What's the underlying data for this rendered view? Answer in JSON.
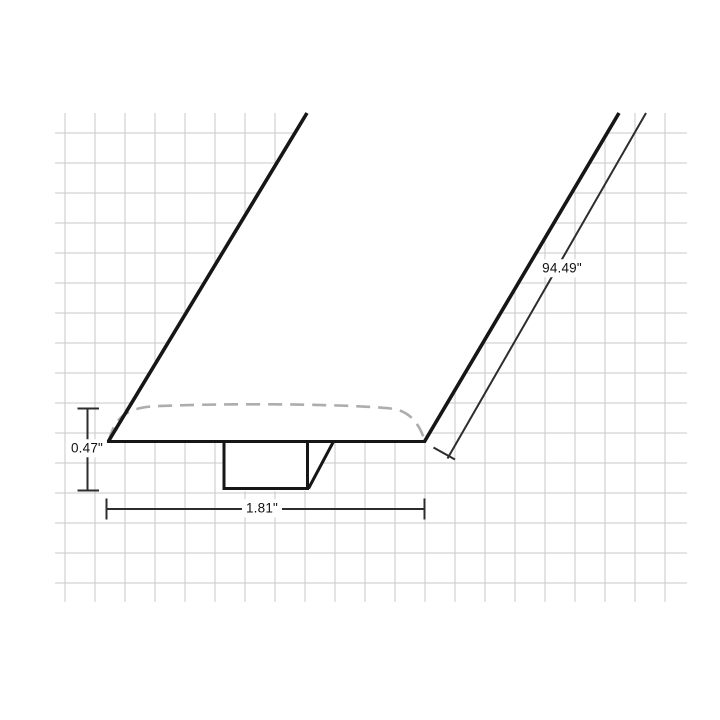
{
  "page": {
    "background": "#ffffff",
    "description": "Technical line drawing of a T-molding floor transition profile on a light grid, shown in perspective with three dimension callouts"
  },
  "colors": {
    "outline": "#161616",
    "dimension_line": "#2d2d2d",
    "grid_line": "#c9c9c9",
    "dashed_surface": "#adadad",
    "label_text": "#111111"
  },
  "diagram": {
    "type": "molding-profile-drawing",
    "dimensions": {
      "height": {
        "label": "0.47\"",
        "value_in": 0.47
      },
      "width": {
        "label": "1.81\"",
        "value_in": 1.81
      },
      "length": {
        "label": "94.49\"",
        "value_in": 94.49
      }
    }
  }
}
